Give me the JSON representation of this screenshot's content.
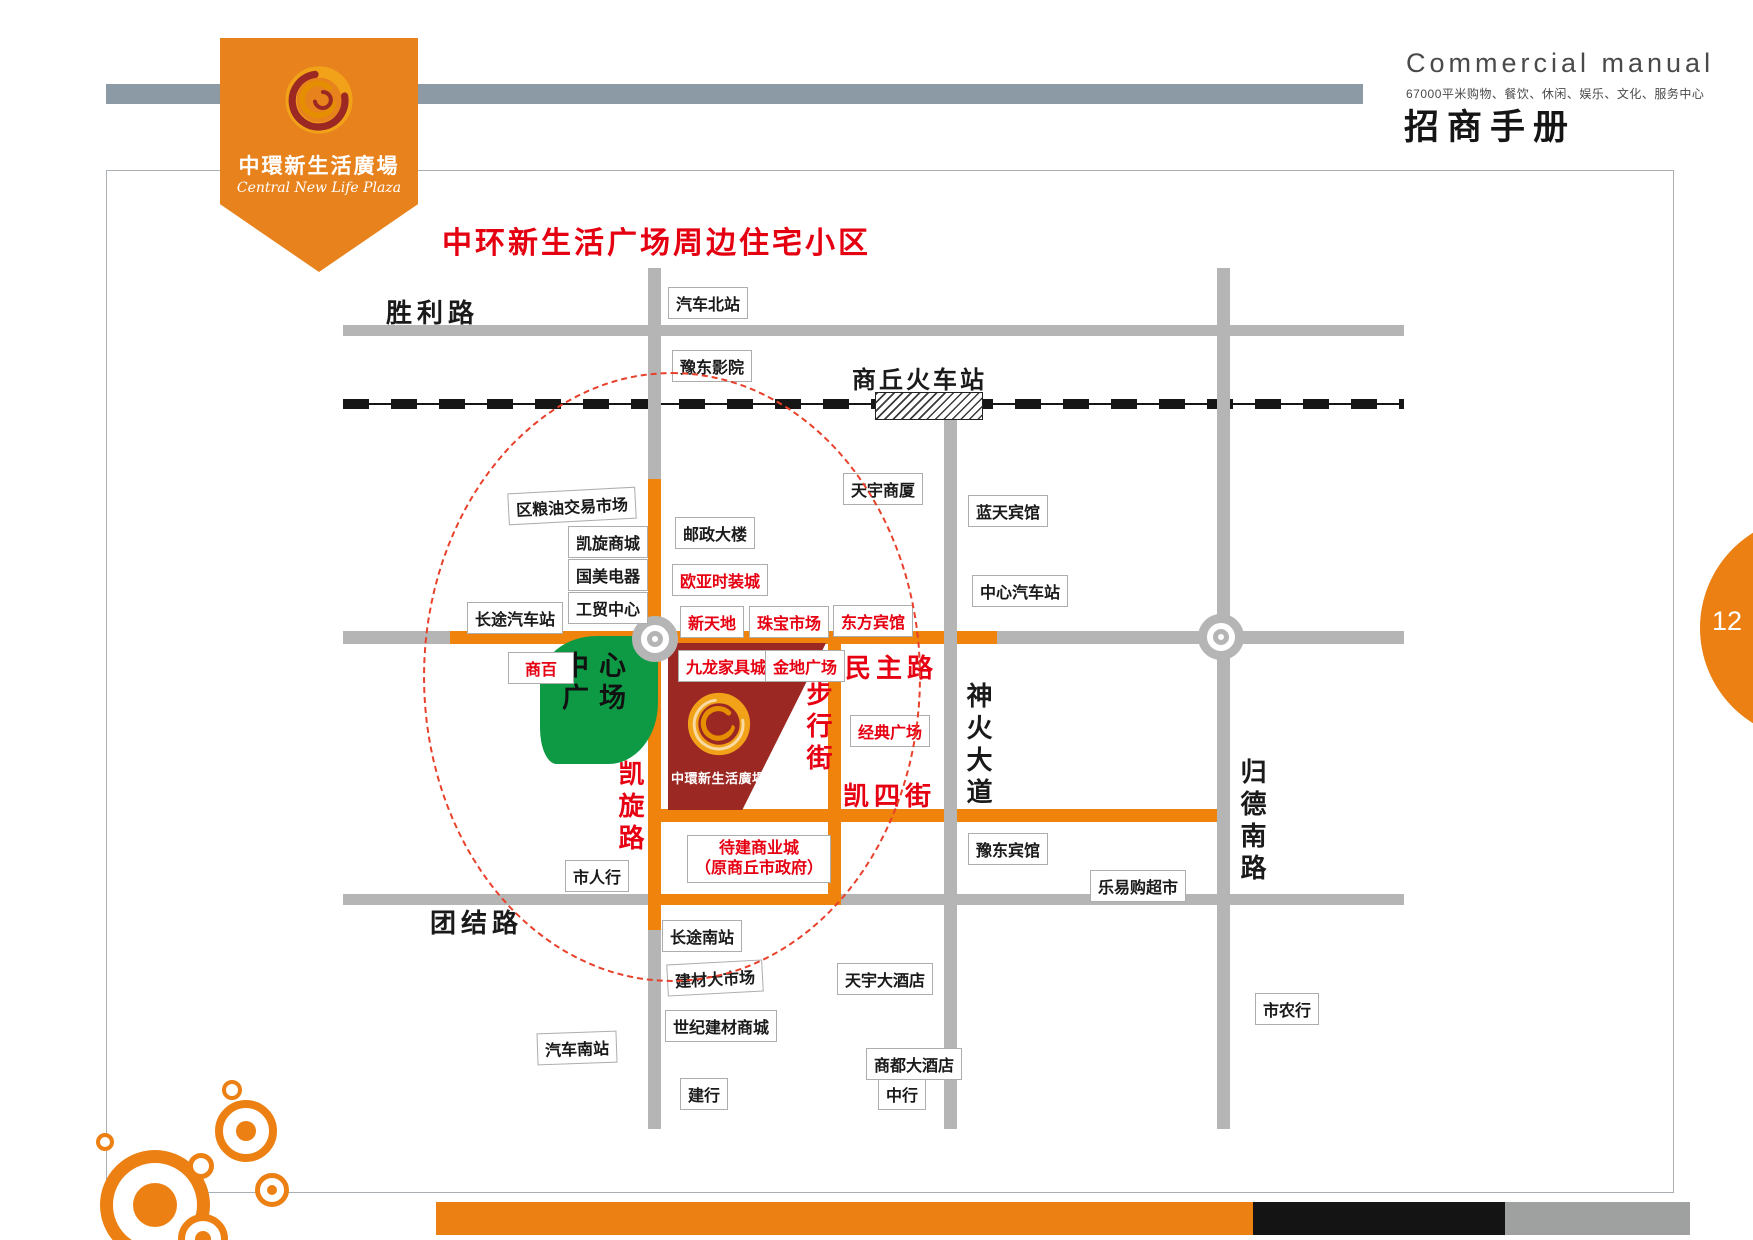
{
  "header": {
    "logo_title_cn": "中環新生活廣場",
    "logo_title_en": "Central New Life Plaza",
    "manual_title_en": "Commercial manual",
    "manual_subtitle_cn": "67000平米购物、餐饮、休闲、娱乐、文化、服务中心",
    "manual_title_cn": "招商手册",
    "page_number": "12"
  },
  "map": {
    "title": "中环新生活广场周边住宅小区",
    "road_labels": {
      "shengli_road": "胜利路",
      "tuanjie_road": "团结路",
      "railway_station": "商丘火车站",
      "shenhuo_avenue": "神火大道",
      "guide_south_road": "归德南路",
      "kaixuan_road": "凯旋路",
      "pedestrian_street": "步行街",
      "minzhu_road": "民主路",
      "kaisi_street": "凯四街"
    },
    "areas": {
      "central_square": "中心广场",
      "plaza_name": "中環新生活廣場",
      "pending_mall_line1": "待建商业城",
      "pending_mall_line2": "（原商丘市政府）"
    },
    "pois": {
      "qichebeizhan": "汽车北站",
      "yudongyingyuan": "豫东影院",
      "tianyushangsha": "天宇商厦",
      "lantianbinguan": "蓝天宾馆",
      "zhongxinqichezhan": "中心汽车站",
      "quliangyoujiaoyishichang": "区粮油交易市场",
      "kaixuanshangcheng": "凯旋商城",
      "guomeidianqi": "国美电器",
      "gongmaozhongxin": "工贸中心",
      "changtuqichezhan": "长途汽车站",
      "youzhengdalou": "邮政大楼",
      "ouyashizhuangcheng": "欧亚时装城",
      "xintiandi": "新天地",
      "zhubaoshichang": "珠宝市场",
      "dongfangbinguan": "东方宾馆",
      "shangbai": "商百",
      "jiulongjiajucheng": "九龙家具城",
      "jindiguangchang": "金地广场",
      "jingdianguangchang": "经典广场",
      "shirenhang": "市人行",
      "changtunanzhan": "长途南站",
      "jiancaidashichang": "建材大市场",
      "shijijiancaishangcheng": "世纪建材商城",
      "qichenanzhan": "汽车南站",
      "jianhang": "建行",
      "tianyudajiudian": "天宇大酒店",
      "zhonghang": "中行",
      "yudongbinguan": "豫东宾馆",
      "leyigouchaoshi": "乐易购超市",
      "shangdudajiudian": "商都大酒店",
      "shinonghang": "市农行"
    }
  },
  "colors": {
    "brand_orange": "#EC8013",
    "road_orange": "#F0830C",
    "road_gray": "#B5B5B5",
    "map_red": "#E60012",
    "plaza_maroon": "#9C2823",
    "square_green": "#0E9A44",
    "slate_gray": "#8C9AA6",
    "railway_black": "#161616"
  }
}
